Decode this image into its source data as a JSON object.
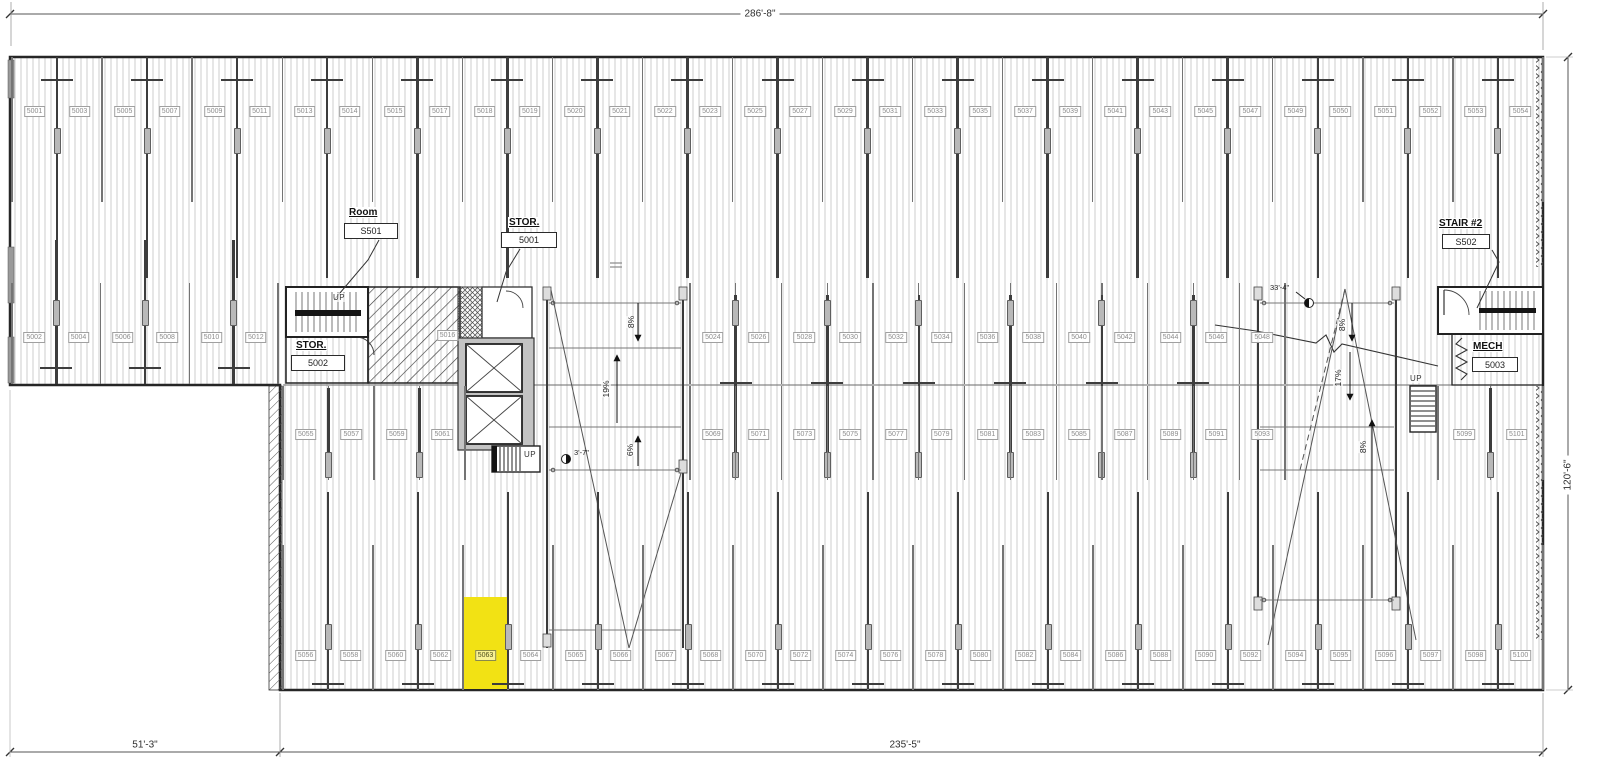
{
  "drawing": {
    "dimensions": {
      "top": "286'-8\"",
      "bottom_left": "51'-3\"",
      "bottom_right": "235'-5\"",
      "right": "120'-6\""
    },
    "rooms": {
      "room_s501": {
        "name": "Room",
        "number": "S501"
      },
      "stor_5001": {
        "name": "STOR.",
        "number": "5001"
      },
      "stor_5002": {
        "name": "STOR.",
        "number": "5002"
      },
      "stair_2": {
        "name": "STAIR #2",
        "number": "S502"
      },
      "mech": {
        "name": "MECH",
        "number": "5003"
      }
    },
    "annotations": {
      "up": "UP",
      "left_ramp": {
        "slope_top": "8%",
        "slope_mid": "19%",
        "slope_bottom": "6%",
        "spot_elevation": "3'-7\""
      },
      "right_ramp": {
        "slope_top": "8%",
        "slope_mid": "17%",
        "slope_bottom": "8%",
        "spot_elevation": "33'-4\""
      }
    },
    "stalls": {
      "row_top": [
        "5001",
        "5003",
        "5005",
        "5007",
        "5009",
        "5011",
        "5013",
        "5014",
        "5015",
        "5017",
        "5018",
        "5019",
        "5020",
        "5021",
        "5022",
        "5023",
        "5025",
        "5027",
        "5029",
        "5031",
        "5033",
        "5035",
        "5037",
        "5039",
        "5041",
        "5043",
        "5045",
        "5047",
        "5049",
        "5050",
        "5051",
        "5052",
        "5053",
        "5054"
      ],
      "row2_left": [
        "5002",
        "5004",
        "5006",
        "5008",
        "5010",
        "5012"
      ],
      "row2_center": [
        "5016"
      ],
      "row2_right": [
        "5024",
        "5026",
        "5028",
        "5030",
        "5032",
        "5034",
        "5036",
        "5038",
        "5040",
        "5042",
        "5044",
        "5046",
        "5048"
      ],
      "row3_left": [
        "5055",
        "5057",
        "5059",
        "5061"
      ],
      "row3_right": [
        "5069",
        "5071",
        "5073",
        "5075",
        "5077",
        "5079",
        "5081",
        "5083",
        "5085",
        "5087",
        "5089",
        "5091",
        "5093"
      ],
      "row3_far_right": [
        "5099",
        "5101"
      ],
      "row_bottom": [
        "5056",
        "5058",
        "5060",
        "5062",
        "5063",
        "5064",
        "5065",
        "5066",
        "5067",
        "5068",
        "5070",
        "5072",
        "5074",
        "5076",
        "5078",
        "5080",
        "5082",
        "5084",
        "5086",
        "5088",
        "5090",
        "5092",
        "5094",
        "5095",
        "5096",
        "5097",
        "5098",
        "5100"
      ]
    },
    "highlighted_stall": "5063",
    "highlight_color": "#f2e214"
  }
}
